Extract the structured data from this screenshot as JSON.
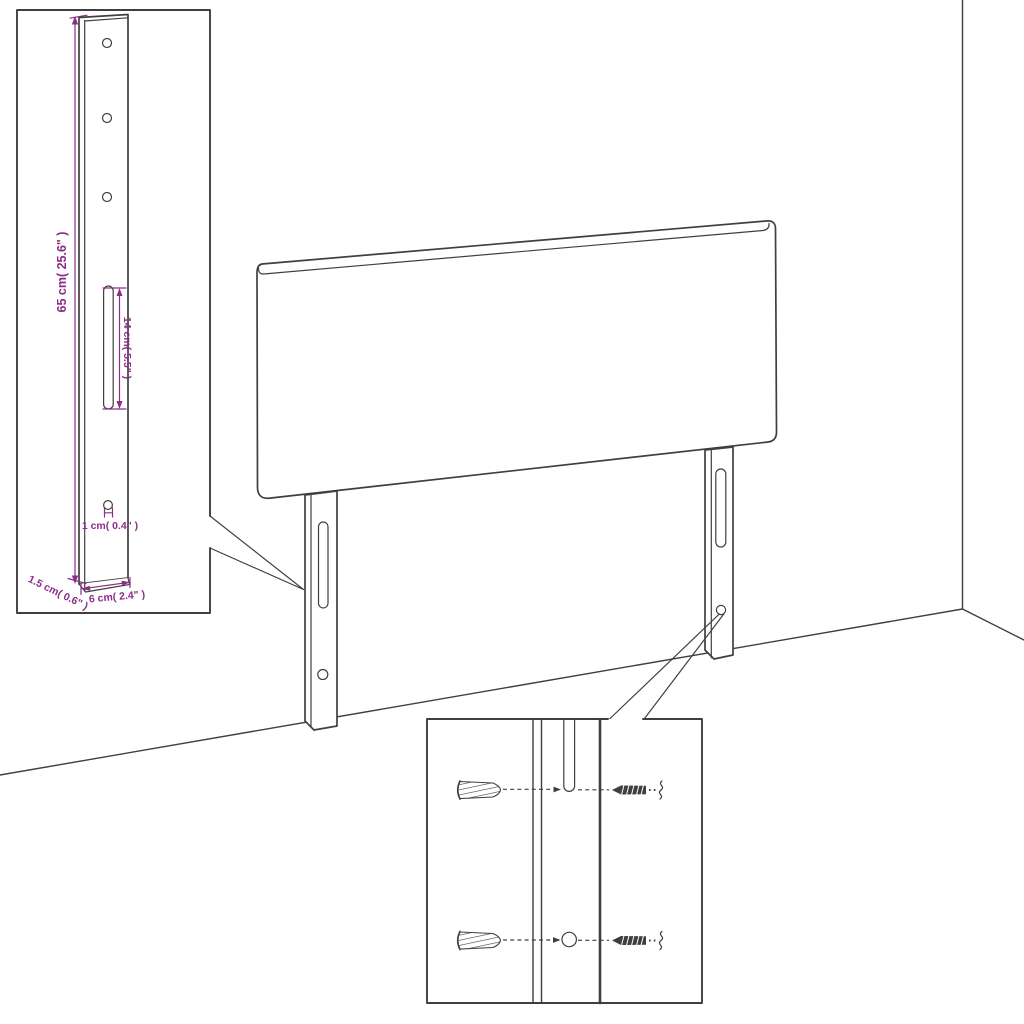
{
  "diagram": {
    "description": "Assembly diagram: headboard with two wall-mount bracket legs, dimensioned bracket detail inset, and wall plug / screw mounting detail inset.",
    "colors": {
      "line": "#3f3f3f",
      "dimension": "#8d2c8a",
      "background": "#ffffff"
    },
    "bracket_detail": {
      "labels": {
        "height": "65 cm( 25.6\" )",
        "slot_length": "14 cm( 5.5\" )",
        "hole_diameter": "1 cm( 0.4\" )",
        "thickness": "1.5 cm( 0.6\" )",
        "width": "6 cm( 2.4\" )"
      }
    }
  }
}
